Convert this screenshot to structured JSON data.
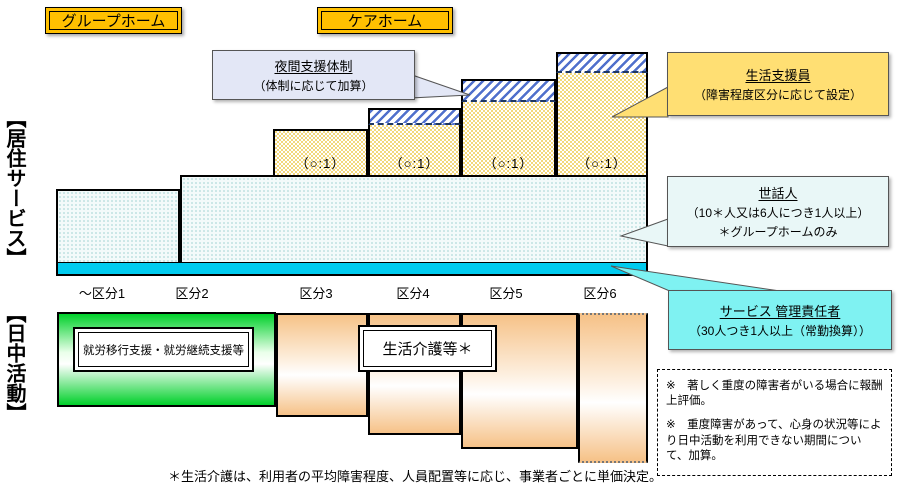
{
  "header": {
    "group_home": "グループホーム",
    "care_home": "ケアホーム"
  },
  "sections": {
    "residential": "【居住サービス】",
    "daytime": "【日中活動】"
  },
  "axis": {
    "categories": [
      "～区分1",
      "区分2",
      "区分3",
      "区分4",
      "区分5",
      "区分6"
    ]
  },
  "bars": {
    "ratio_label": "（○:1）"
  },
  "callouts": {
    "night_support": {
      "title": "夜間支援体制",
      "body": "（体制に応じて加算）"
    },
    "life_support_staff": {
      "title": "生活支援員",
      "body": "（障害程度区分に応じて設定）"
    },
    "caretaker": {
      "title": "世話人",
      "body": "（10＊人又は6人につき1人以上）",
      "note": "＊グループホームのみ"
    },
    "service_manager": {
      "title": "サービス 管理責任者",
      "body": "（30人つき1人以上（常勤換算））"
    }
  },
  "daytime_chart": {
    "employment_label": "就労移行支援・就労継続支援等",
    "care_label": "生活介護等＊"
  },
  "notes": {
    "box_note1": "※　著しく重度の障害者がいる場合に報酬上評価。",
    "box_note2": "※　重度障害があって、心身の状況等により日中活動を利用できない期間について、加算。",
    "footnote": "＊生活介護は、利用者の平均障害程度、人員配置等に応じ、事業者ごとに単価決定。"
  },
  "diagram_structure": {
    "residential_layers_by_category": {
      "～区分1": [
        "サービス管理責任者",
        "世話人"
      ],
      "区分2": [
        "サービス管理責任者",
        "世話人"
      ],
      "区分3": [
        "サービス管理責任者",
        "世話人",
        "生活支援員（○:1）"
      ],
      "区分4": [
        "サービス管理責任者",
        "世話人",
        "生活支援員（○:1）",
        "夜間支援体制"
      ],
      "区分5": [
        "サービス管理責任者",
        "世話人",
        "生活支援員（○:1）",
        "夜間支援体制"
      ],
      "区分6": [
        "サービス管理責任者",
        "世話人",
        "生活支援員（○:1）",
        "夜間支援体制"
      ]
    },
    "daytime_by_category": {
      "～区分1_区分2": "就労移行支援・就労継続支援等",
      "区分3_区分6": "生活介護等＊（区分が上がるほど深い段形）"
    },
    "colors": {
      "gold_tag": "#FFC000",
      "cyan_strip": "#00CBEF",
      "manager_callout": "#7FF2F2",
      "caretaker_callout": "#E9F7F7",
      "life_support_callout": "#FFDF73",
      "night_callout": "#E3E7F6",
      "hatch_blue": "#5070CC",
      "bar_yellow": "#F2D87C",
      "green_bar": "#00D02A",
      "orange_bar": "#F6C288"
    }
  }
}
